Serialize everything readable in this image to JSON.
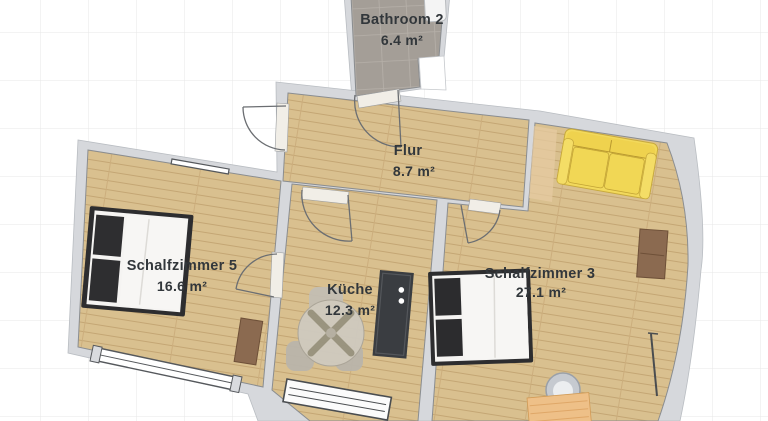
{
  "rooms": [
    {
      "id": "bathroom-2",
      "name": "Bathroom 2",
      "area": "6.4 m²",
      "floor": "tile"
    },
    {
      "id": "flur",
      "name": "Flur",
      "area": "8.7 m²",
      "floor": "wood"
    },
    {
      "id": "schalfzimmer-5",
      "name": "Schalfzimmer 5",
      "area": "16.6 m²",
      "floor": "wood"
    },
    {
      "id": "kueche",
      "name": "Küche",
      "area": "12.3 m²",
      "floor": "wood"
    },
    {
      "id": "schalfzimmer-3",
      "name": "Schalfzimmer 3",
      "area": "27.1 m²",
      "floor": "wood"
    }
  ],
  "furniture": [
    {
      "room": "schalfzimmer-5",
      "item": "double-bed"
    },
    {
      "room": "schalfzimmer-5",
      "item": "wardrobe"
    },
    {
      "room": "schalfzimmer-5",
      "item": "window"
    },
    {
      "room": "kueche",
      "item": "dining-table"
    },
    {
      "room": "kueche",
      "item": "chairs"
    },
    {
      "room": "kueche",
      "item": "kitchen-counter"
    },
    {
      "room": "kueche",
      "item": "radiator"
    },
    {
      "room": "schalfzimmer-3",
      "item": "double-bed"
    },
    {
      "room": "schalfzimmer-3",
      "item": "sofa"
    },
    {
      "room": "schalfzimmer-3",
      "item": "dresser"
    },
    {
      "room": "schalfzimmer-3",
      "item": "desk"
    },
    {
      "room": "schalfzimmer-3",
      "item": "office-chair"
    }
  ],
  "colors": {
    "wood": "#d9c08f",
    "wood_stripe": "#c4a674",
    "tile": "#a49e97",
    "wall": "#d6d8dc",
    "sofa": "#f2d95c",
    "bed_frame": "#2d2d2f",
    "label": "#32373b",
    "grid_line": "#e7e7e7"
  }
}
